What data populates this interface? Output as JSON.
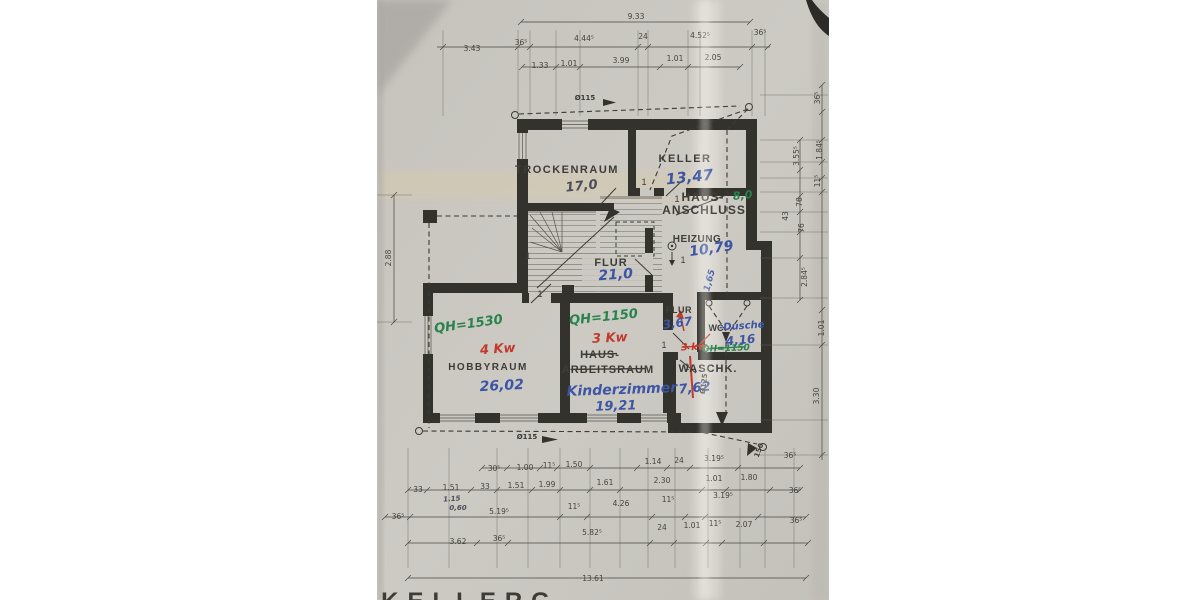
{
  "plan": {
    "door_symbol": "1",
    "printed": [
      {
        "t": "TROCKENRAUM",
        "x": 567,
        "y": 173,
        "s": 11,
        "ls": 1.5
      },
      {
        "t": "KELLER",
        "x": 685,
        "y": 162,
        "s": 11,
        "ls": 1.5
      },
      {
        "t": "HAUS-",
        "x": 703,
        "y": 201,
        "s": 12,
        "ls": 1
      },
      {
        "t": "ANSCHLUSS",
        "x": 704,
        "y": 214,
        "s": 12,
        "ls": 1
      },
      {
        "t": "HEIZUNG",
        "x": 697,
        "y": 242,
        "s": 10,
        "ls": 0.5
      },
      {
        "t": "FLUR",
        "x": 611,
        "y": 266,
        "s": 11,
        "ls": 1
      },
      {
        "t": "FLUR",
        "x": 679,
        "y": 313,
        "s": 9,
        "ls": 0.5
      },
      {
        "t": "WC",
        "x": 716,
        "y": 331,
        "s": 9
      },
      {
        "t": "WASCHK.",
        "x": 708,
        "y": 372,
        "s": 11,
        "ls": 1
      },
      {
        "t": "HOBBYRAUM",
        "x": 488,
        "y": 370,
        "s": 10,
        "ls": 1.5
      },
      {
        "t": "HAUS-",
        "x": 600,
        "y": 358,
        "s": 11,
        "ls": 1,
        "k": true
      },
      {
        "t": "ARBEITSRAUM",
        "x": 608,
        "y": 373,
        "s": 11,
        "ls": 1,
        "k": true
      },
      {
        "t": "KELLERG",
        "x": 470,
        "y": 609,
        "s": 24,
        "ls": 9
      }
    ],
    "blue": [
      {
        "t": "13,47",
        "x": 690,
        "y": 182,
        "s": 15,
        "r": -6
      },
      {
        "t": "10,79",
        "x": 712,
        "y": 253,
        "s": 14,
        "r": -8
      },
      {
        "t": "21,0",
        "x": 616,
        "y": 279,
        "s": 14,
        "r": -4
      },
      {
        "t": "3,67",
        "x": 678,
        "y": 327,
        "s": 12,
        "r": -8
      },
      {
        "t": "-Dusche",
        "x": 742,
        "y": 329,
        "s": 10,
        "r": -4
      },
      {
        "t": "4,16",
        "x": 741,
        "y": 344,
        "s": 12,
        "r": -6
      },
      {
        "t": "7,62",
        "x": 695,
        "y": 392,
        "s": 13,
        "r": -6
      },
      {
        "t": "26,02",
        "x": 502,
        "y": 390,
        "s": 14,
        "r": -3
      },
      {
        "t": "Kinderzimmer",
        "x": 622,
        "y": 394,
        "s": 14,
        "r": -2
      },
      {
        "t": "19,21",
        "x": 616,
        "y": 410,
        "s": 13,
        "r": -2
      },
      {
        "t": "1,65",
        "x": 712,
        "y": 281,
        "s": 9,
        "r": -75
      }
    ],
    "pencil": [
      {
        "t": "17,0",
        "x": 582,
        "y": 190,
        "s": 13,
        "r": -6
      },
      {
        "t": "1.15",
        "x": 452,
        "y": 501,
        "s": 7,
        "r": -4
      },
      {
        "t": "0,60",
        "x": 458,
        "y": 510,
        "s": 7
      }
    ],
    "red": [
      {
        "t": "4 Kw",
        "x": 498,
        "y": 353,
        "s": 13,
        "r": -4
      },
      {
        "t": "3 Kw",
        "x": 610,
        "y": 342,
        "s": 13,
        "r": -3
      },
      {
        "t": "3 kw",
        "x": 694,
        "y": 350,
        "s": 10,
        "r": -2,
        "k": true
      }
    ],
    "green": [
      {
        "t": "QH=1530",
        "x": 469,
        "y": 328,
        "s": 13,
        "r": -8
      },
      {
        "t": "QH=1150",
        "x": 604,
        "y": 321,
        "s": 13,
        "r": -6
      },
      {
        "t": "QH=1150",
        "x": 726,
        "y": 351,
        "s": 9,
        "r": -2,
        "k": true
      },
      {
        "t": "8,0",
        "x": 743,
        "y": 199,
        "s": 11,
        "r": -6
      }
    ],
    "pipes": [
      {
        "t": "Ø115",
        "x": 585,
        "y": 100
      },
      {
        "t": "Ø115",
        "x": 527,
        "y": 439
      },
      {
        "t": "Ø125",
        "x": 706,
        "y": 384,
        "r": -83
      },
      {
        "t": "150",
        "x": 761,
        "y": 451,
        "r": -70
      }
    ],
    "doors": [
      {
        "x": 528,
        "y": 259
      },
      {
        "x": 540,
        "y": 297
      },
      {
        "x": 644,
        "y": 185
      },
      {
        "x": 677,
        "y": 202
      },
      {
        "x": 683,
        "y": 263
      },
      {
        "x": 664,
        "y": 348
      },
      {
        "x": 687,
        "y": 370
      }
    ]
  },
  "dimensions": {
    "all": [
      {
        "t": "9.33",
        "x": 636,
        "y": 19
      },
      {
        "t": "3.43",
        "x": 472,
        "y": 51
      },
      {
        "t": "36⁵",
        "x": 521,
        "y": 45
      },
      {
        "t": "4.44⁵",
        "x": 584,
        "y": 41
      },
      {
        "t": "24",
        "x": 643,
        "y": 39
      },
      {
        "t": "4.52⁵",
        "x": 700,
        "y": 38
      },
      {
        "t": "36⁵",
        "x": 760,
        "y": 35
      },
      {
        "t": "1.33",
        "x": 540,
        "y": 68
      },
      {
        "t": "1.01",
        "x": 569,
        "y": 66
      },
      {
        "t": "3.99",
        "x": 621,
        "y": 63
      },
      {
        "t": "1.01",
        "x": 675,
        "y": 61
      },
      {
        "t": "2.05",
        "x": 713,
        "y": 60
      },
      {
        "t": "2.88",
        "x": 391,
        "y": 258,
        "r": -90
      },
      {
        "t": "36⁵",
        "x": 820,
        "y": 98,
        "r": -90
      },
      {
        "t": "3.55⁵",
        "x": 799,
        "y": 156,
        "r": -90
      },
      {
        "t": "1.84⁵",
        "x": 822,
        "y": 150,
        "r": -90
      },
      {
        "t": "11⁵",
        "x": 820,
        "y": 181,
        "r": -90
      },
      {
        "t": "76",
        "x": 802,
        "y": 202,
        "r": -90
      },
      {
        "t": "43",
        "x": 788,
        "y": 216,
        "r": -90
      },
      {
        "t": "76",
        "x": 804,
        "y": 228,
        "r": -90
      },
      {
        "t": "2.84⁵",
        "x": 807,
        "y": 277,
        "r": -90
      },
      {
        "t": "1.01",
        "x": 824,
        "y": 328,
        "r": -90
      },
      {
        "t": "3.30",
        "x": 819,
        "y": 396,
        "r": -90
      },
      {
        "t": "30⁵",
        "x": 494,
        "y": 471
      },
      {
        "t": "1.00",
        "x": 525,
        "y": 470
      },
      {
        "t": "11⁵",
        "x": 549,
        "y": 468
      },
      {
        "t": "1.50",
        "x": 574,
        "y": 467
      },
      {
        "t": "1.14",
        "x": 653,
        "y": 464
      },
      {
        "t": "24",
        "x": 679,
        "y": 463
      },
      {
        "t": "3.19⁵",
        "x": 714,
        "y": 461
      },
      {
        "t": "36⁵",
        "x": 790,
        "y": 458
      },
      {
        "t": "33",
        "x": 418,
        "y": 492
      },
      {
        "t": "1.51",
        "x": 451,
        "y": 490
      },
      {
        "t": "33",
        "x": 485,
        "y": 489
      },
      {
        "t": "1.51",
        "x": 516,
        "y": 488
      },
      {
        "t": "1.99",
        "x": 547,
        "y": 487
      },
      {
        "t": "1.61",
        "x": 605,
        "y": 485
      },
      {
        "t": "2.30",
        "x": 662,
        "y": 483
      },
      {
        "t": "1.01",
        "x": 714,
        "y": 481
      },
      {
        "t": "1.80",
        "x": 749,
        "y": 480
      },
      {
        "t": "36⁵",
        "x": 398,
        "y": 519
      },
      {
        "t": "5.19⁵",
        "x": 499,
        "y": 514
      },
      {
        "t": "11⁵",
        "x": 574,
        "y": 509
      },
      {
        "t": "4.26",
        "x": 621,
        "y": 506
      },
      {
        "t": "11⁵",
        "x": 668,
        "y": 502
      },
      {
        "t": "3.19⁵",
        "x": 723,
        "y": 498
      },
      {
        "t": "36⁵",
        "x": 795,
        "y": 493
      },
      {
        "t": "3.62",
        "x": 458,
        "y": 544
      },
      {
        "t": "36⁵",
        "x": 499,
        "y": 541
      },
      {
        "t": "5.82⁵",
        "x": 592,
        "y": 535
      },
      {
        "t": "24",
        "x": 662,
        "y": 530
      },
      {
        "t": "1.01",
        "x": 692,
        "y": 528
      },
      {
        "t": "11⁵",
        "x": 715,
        "y": 526
      },
      {
        "t": "2.07",
        "x": 744,
        "y": 527
      },
      {
        "t": "36⁵",
        "x": 796,
        "y": 523
      },
      {
        "t": "13.61",
        "x": 593,
        "y": 581
      }
    ]
  },
  "colors": {
    "paper": "#cbc8c2",
    "ink": "#34322c",
    "blue": "#3c55a4",
    "red": "#c23a2c",
    "green": "#27824c",
    "crease": "#d8cba9"
  }
}
